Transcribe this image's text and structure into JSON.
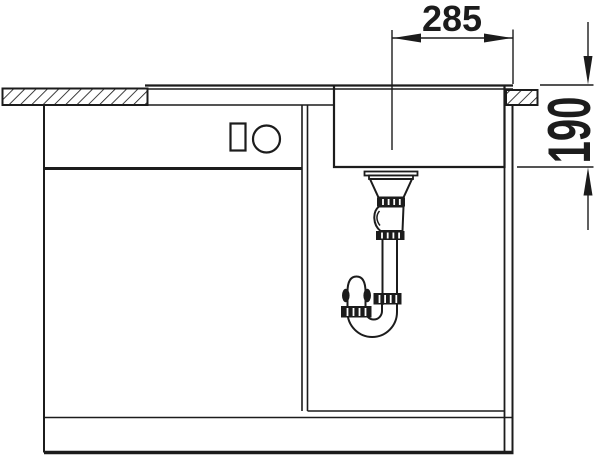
{
  "diagram": {
    "kind": "sink-installation-section-drawing",
    "background_color": "#ffffff",
    "line_color": "#1c1c1c",
    "dimensions": [
      {
        "name": "drain-center-to-right-edge-width",
        "value": "285",
        "orientation": "horizontal"
      },
      {
        "name": "bowl-depth",
        "value": "190",
        "orientation": "vertical"
      }
    ],
    "components": [
      "countertop-section-left",
      "countertop-section-right",
      "sink-rim",
      "sink-bowl",
      "drain-strainer",
      "siphon-trap",
      "base-cabinet",
      "cabinet-partition",
      "drawer-front-symbols"
    ]
  }
}
